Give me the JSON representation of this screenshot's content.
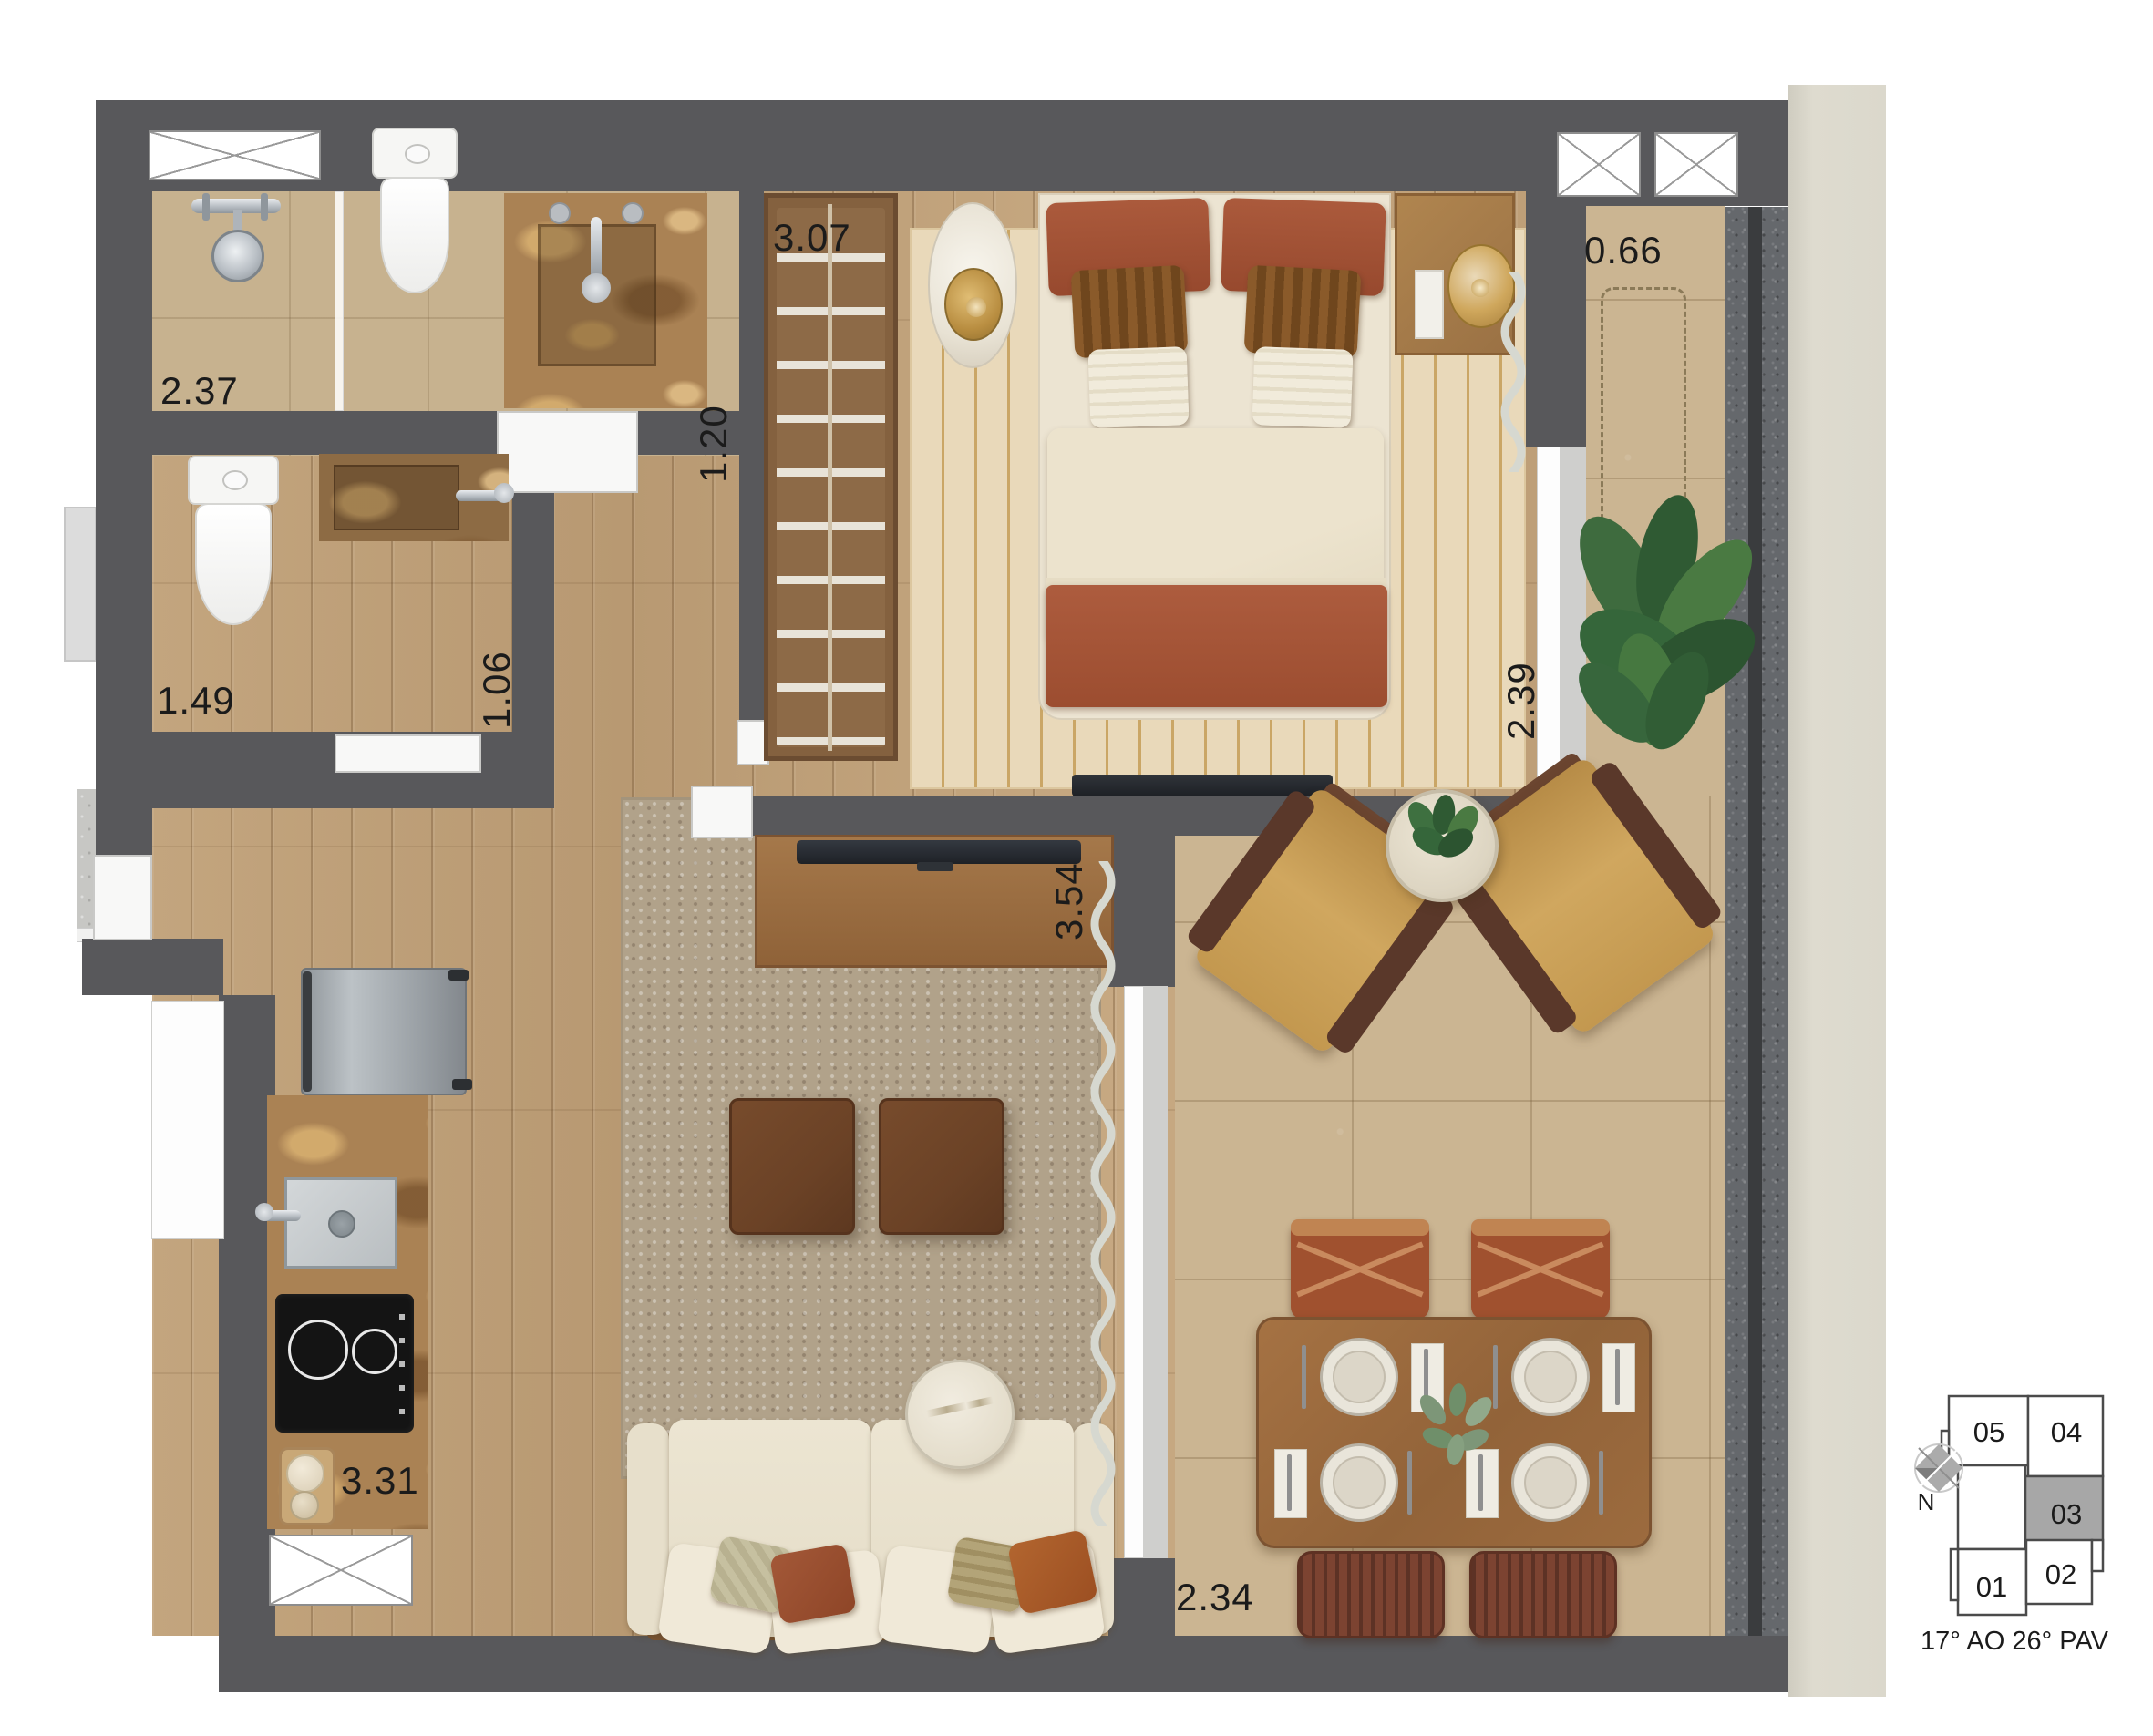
{
  "plan": {
    "dimension_labels": {
      "shower_width": "2.37",
      "bath_passage": "1.20",
      "closet_length": "3.07",
      "balcony_width": "0.66",
      "lavabo_length": "1.49",
      "lavabo_width": "1.06",
      "living_length": "3.54",
      "bedroom_width": "2.39",
      "kitchen_length": "3.31",
      "terrace_width": "2.34"
    }
  },
  "keyplan": {
    "units": [
      {
        "id": "05",
        "highlighted": false
      },
      {
        "id": "04",
        "highlighted": false
      },
      {
        "id": "03",
        "highlighted": true
      },
      {
        "id": "02",
        "highlighted": false
      },
      {
        "id": "01",
        "highlighted": false
      }
    ],
    "north_label": "N",
    "caption": "17° AO 26° PAV",
    "highlight_color": "#a7a7a7"
  },
  "palette": {
    "wall": "#58585b",
    "wood_floor": "#c0a077",
    "terrace_tile": "#cbb592",
    "bath_tile": "#c7b28f",
    "bedroom_rug": "#e9d9ba",
    "living_rug": "#b1a28a",
    "accent_terracotta": "#a4563a",
    "granite": "#65686c",
    "facade_column": "#dbd8cc"
  }
}
